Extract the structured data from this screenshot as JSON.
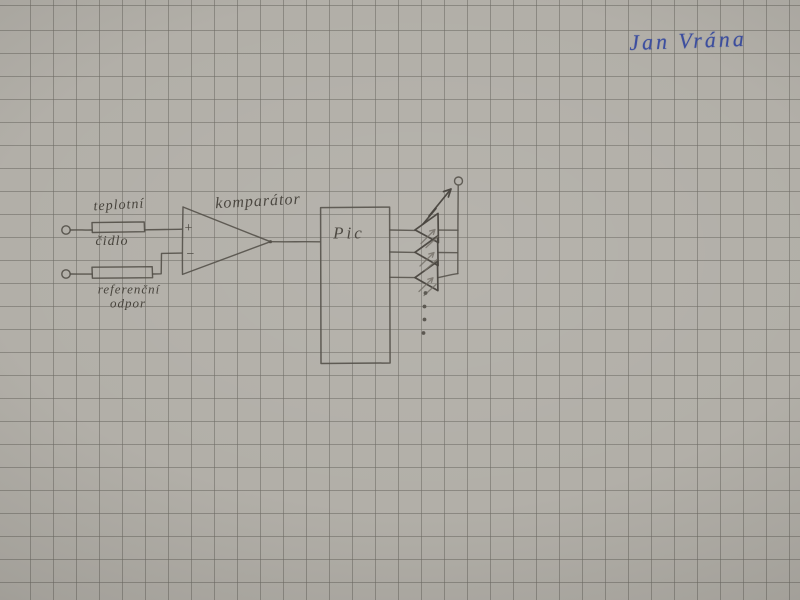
{
  "photo": {
    "signature": "Jan Vrána"
  },
  "schematic": {
    "labels": {
      "sensor_line1": "teplotní",
      "sensor_line2": "čidlo",
      "reference_line1": "referenční",
      "reference_line2": "odpor",
      "comparator": "komparátor",
      "mcu": "Pic",
      "plus_input": "+",
      "minus_input": "−"
    },
    "colors": {
      "paper": "#b2afa8",
      "grid_line": "#9c9991",
      "pencil": "#4f4b44",
      "pencil_dark": "#3f3b35",
      "pencil_light": "#6b675e",
      "pen_blue": "#3c4e9f"
    }
  }
}
